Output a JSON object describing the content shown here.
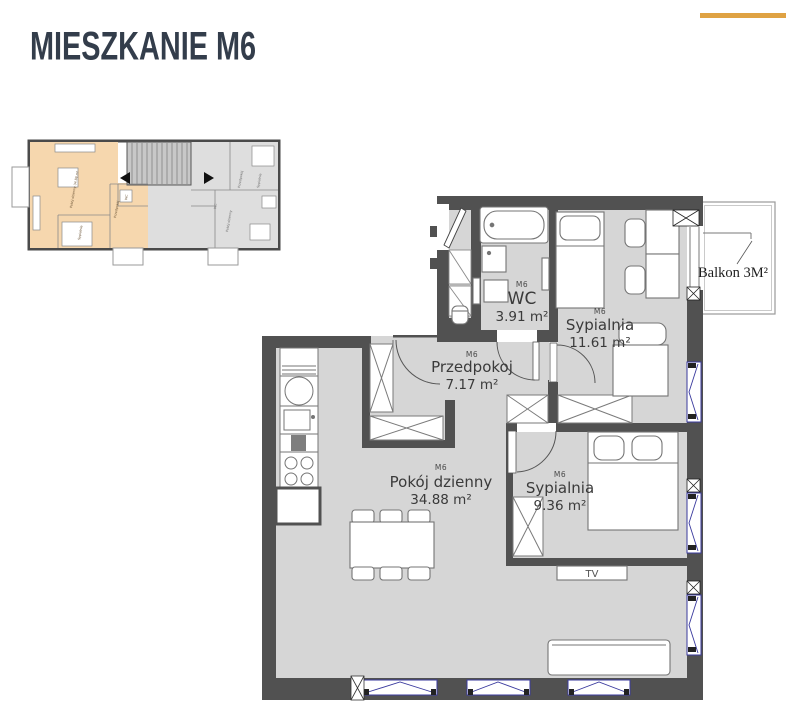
{
  "header": {
    "title": "MIESZKANIE M6"
  },
  "accent": {
    "line_color": "#DFA243"
  },
  "overview_plan": {
    "highlight_color": "#F6D7AE",
    "labels": [
      "Pokój dzienny 34.88 m²",
      "Sypialnia",
      "Przedpokój",
      "WC",
      "Pokój dzienny",
      "Sypialnia",
      "Przedpokój",
      "WC"
    ]
  },
  "floor_plan": {
    "unit": "M6",
    "rooms": [
      {
        "unit": "M6",
        "name": "WC",
        "area": "3.91 m²"
      },
      {
        "unit": "M6",
        "name": "Sypialnia",
        "area": "11.61 m²"
      },
      {
        "unit": "M6",
        "name": "Przedpokoj",
        "area": "7.17 m²"
      },
      {
        "unit": "M6",
        "name": "Pokój dzienny",
        "area": "34.88 m²"
      },
      {
        "unit": "M6",
        "name": "Sypialnia",
        "area": "9.36 m²"
      }
    ],
    "balcony_label": "Balkon 3M²",
    "tv_label": "TV"
  },
  "colors": {
    "wall": "#515151",
    "floor": "#D6D6D6",
    "window": "#3A3A9E",
    "title": "#333D4B"
  }
}
